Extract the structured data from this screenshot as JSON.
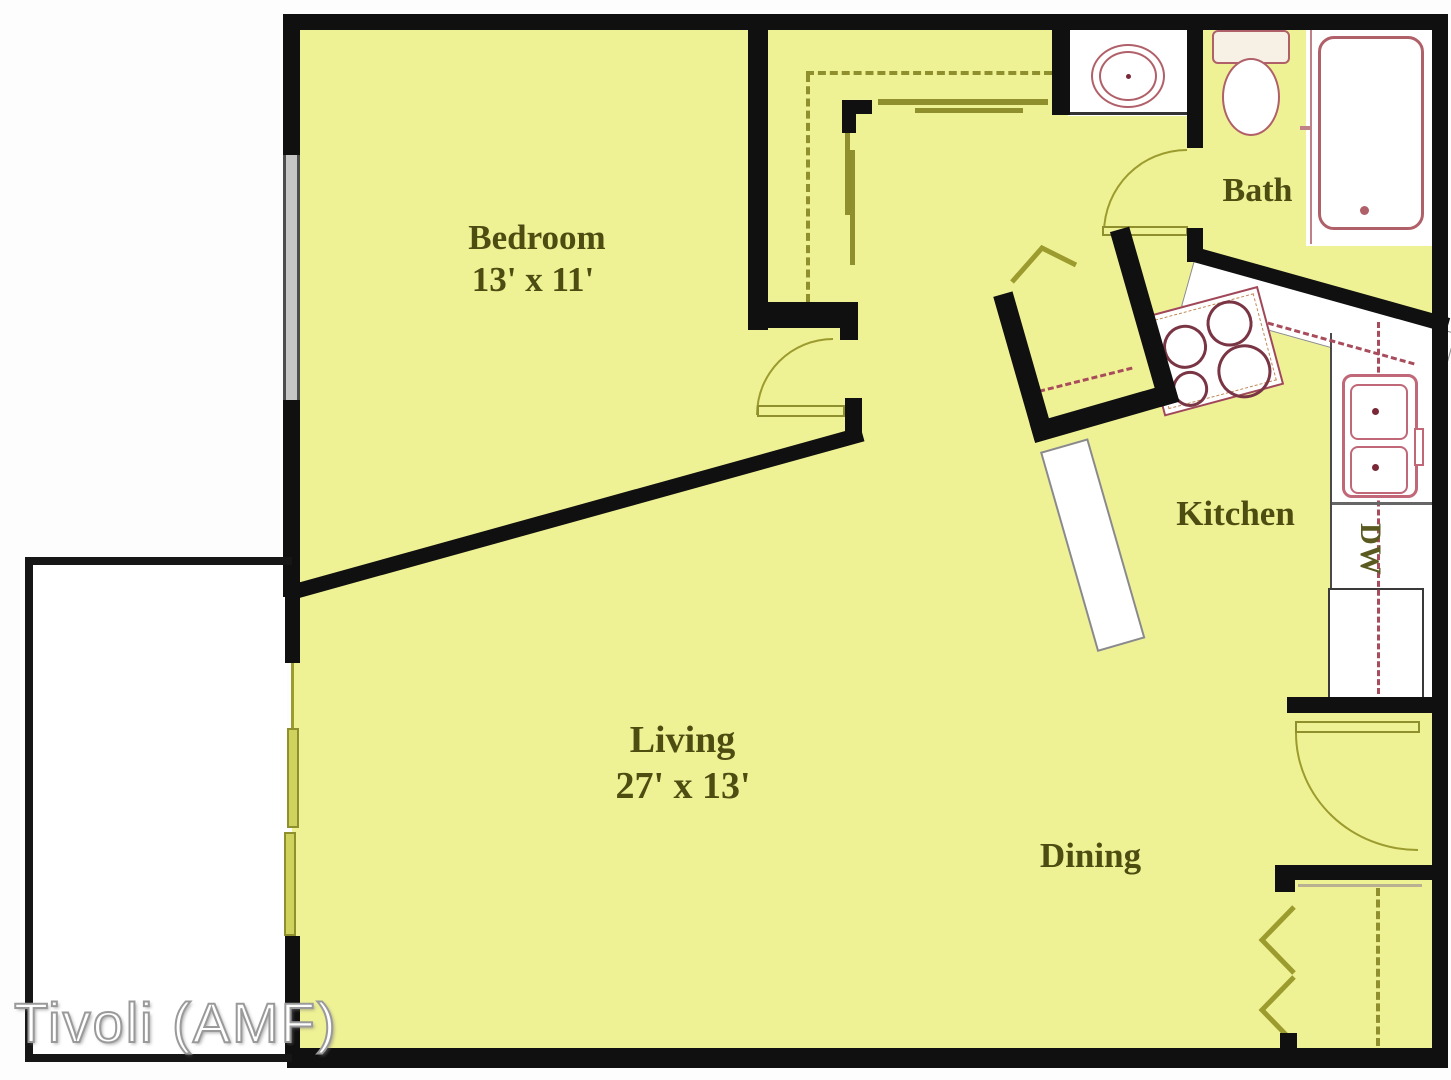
{
  "watermark": "Tivoli (AMF)",
  "rooms": {
    "bedroom": {
      "name": "Bedroom",
      "dims": "13' x 11'"
    },
    "living": {
      "name": "Living",
      "dims": "27' x 13'"
    },
    "dining": {
      "name": "Dining"
    },
    "kitchen": {
      "name": "Kitchen"
    },
    "bath": {
      "name": "Bath"
    }
  },
  "appliances": {
    "dishwasher": "DW"
  },
  "fixtures": [
    "bathtub",
    "toilet",
    "vanity-sink",
    "kitchen-sink",
    "stove",
    "dishwasher",
    "window",
    "sliding-glass-door",
    "bifold-closet-doors",
    "patio",
    "utility-closet"
  ],
  "colors": {
    "floor": "#eff195",
    "wall": "#101010",
    "fixture_outline": "#b06068",
    "cabinet_dash": "#a84c5c",
    "door_olive": "#8f8f2e",
    "label_text": "#4d4d12"
  }
}
